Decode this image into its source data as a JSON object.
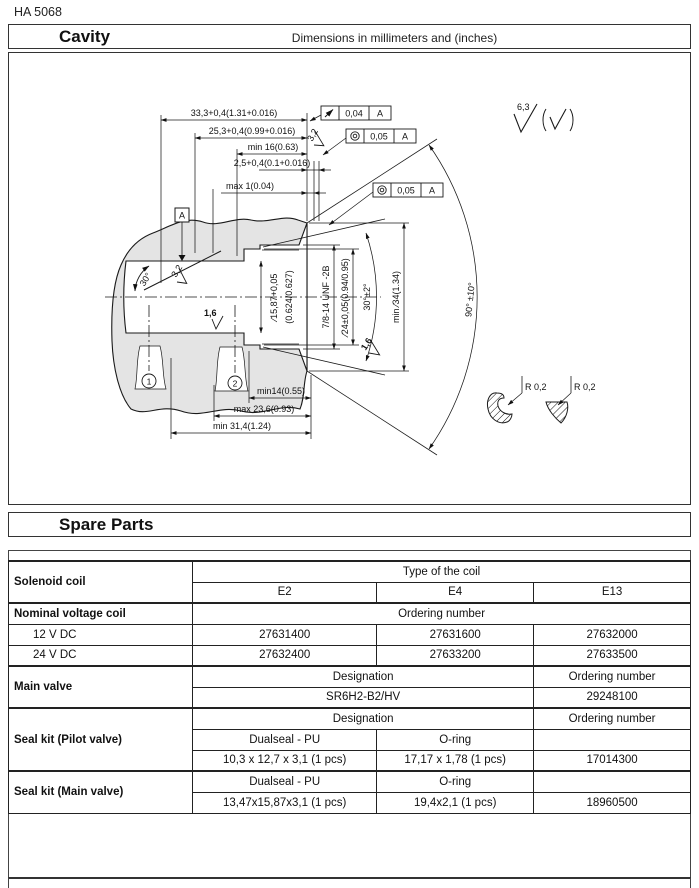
{
  "page": {
    "doc_number": "HA 5068"
  },
  "cavity": {
    "title": "Cavity",
    "subtitle": "Dimensions in millimeters and (inches)",
    "datum": "A",
    "dims": {
      "depth_total": "33,3+0,4(1.31+0.016)",
      "depth_thread": "25,3+0,4(0.99+0.016)",
      "thread_min": "min 16(0.63)",
      "spotface_depth": "2,5+0,4(0.1+0.016)",
      "chamfer_max": "max 1(0.04)",
      "bottom_min14": "min14(0.55)",
      "bottom_max236": "max 23,6(0.93)",
      "bottom_min314": "min 31,4(1.24)",
      "bore_mm": "∕15,87+0,05",
      "bore_in": "(0.624/0.627)",
      "thread": "7/8-14 UNF -2B",
      "seal_bore": "∕24±0,05(0.94/0.95)",
      "seat_angle": "30°±2°",
      "spotface_dia": "min ∕34(1.34)",
      "cone_angle": "90° ±10°",
      "lead_angle": "30°",
      "radius": "R 0,2"
    },
    "finish": {
      "general": "6,3",
      "fine": "3,2",
      "finest": "1,6"
    },
    "fcf": [
      {
        "symbol": "runout",
        "value": "0,04",
        "datum": "A"
      },
      {
        "symbol": "concentricity",
        "value": "0,05",
        "datum": "A"
      },
      {
        "symbol": "concentricity",
        "value": "0,05",
        "datum": "A"
      }
    ],
    "callouts": {
      "c1": "1",
      "c2": "2"
    }
  },
  "spare_parts": {
    "title": "Spare Parts",
    "solenoid": {
      "label": "Solenoid coil",
      "type_header": "Type of the coil",
      "coils": [
        "E2",
        "E4",
        "E13"
      ]
    },
    "voltage": {
      "label": "Nominal voltage coil",
      "header": "Ordering number",
      "rows": [
        {
          "v": "12 V DC",
          "nums": [
            "27631400",
            "27631600",
            "27632000"
          ]
        },
        {
          "v": "24 V DC",
          "nums": [
            "27632400",
            "27633200",
            "27633500"
          ]
        }
      ]
    },
    "main_valve": {
      "label": "Main valve",
      "designation_header": "Designation",
      "ordering_header": "Ordering number",
      "designation": "SR6H2-B2/HV",
      "ordering": "29248100"
    },
    "seal_pilot": {
      "label": "Seal kit (Pilot valve)",
      "designation_header": "Designation",
      "ordering_header": "Ordering number",
      "seal1": "Dualseal - PU",
      "seal2": "O-ring",
      "size1": "10,3 x 12,7 x 3,1 (1 pcs)",
      "size2": "17,17 x 1,78 (1 pcs)",
      "ordering": "17014300"
    },
    "seal_main": {
      "label": "Seal kit (Main valve)",
      "seal1": "Dualseal - PU",
      "seal2": "O-ring",
      "size1": "13,47x15,87x3,1 (1 pcs)",
      "size2": "19,4x2,1 (1 pcs)",
      "ordering": "18960500"
    }
  }
}
